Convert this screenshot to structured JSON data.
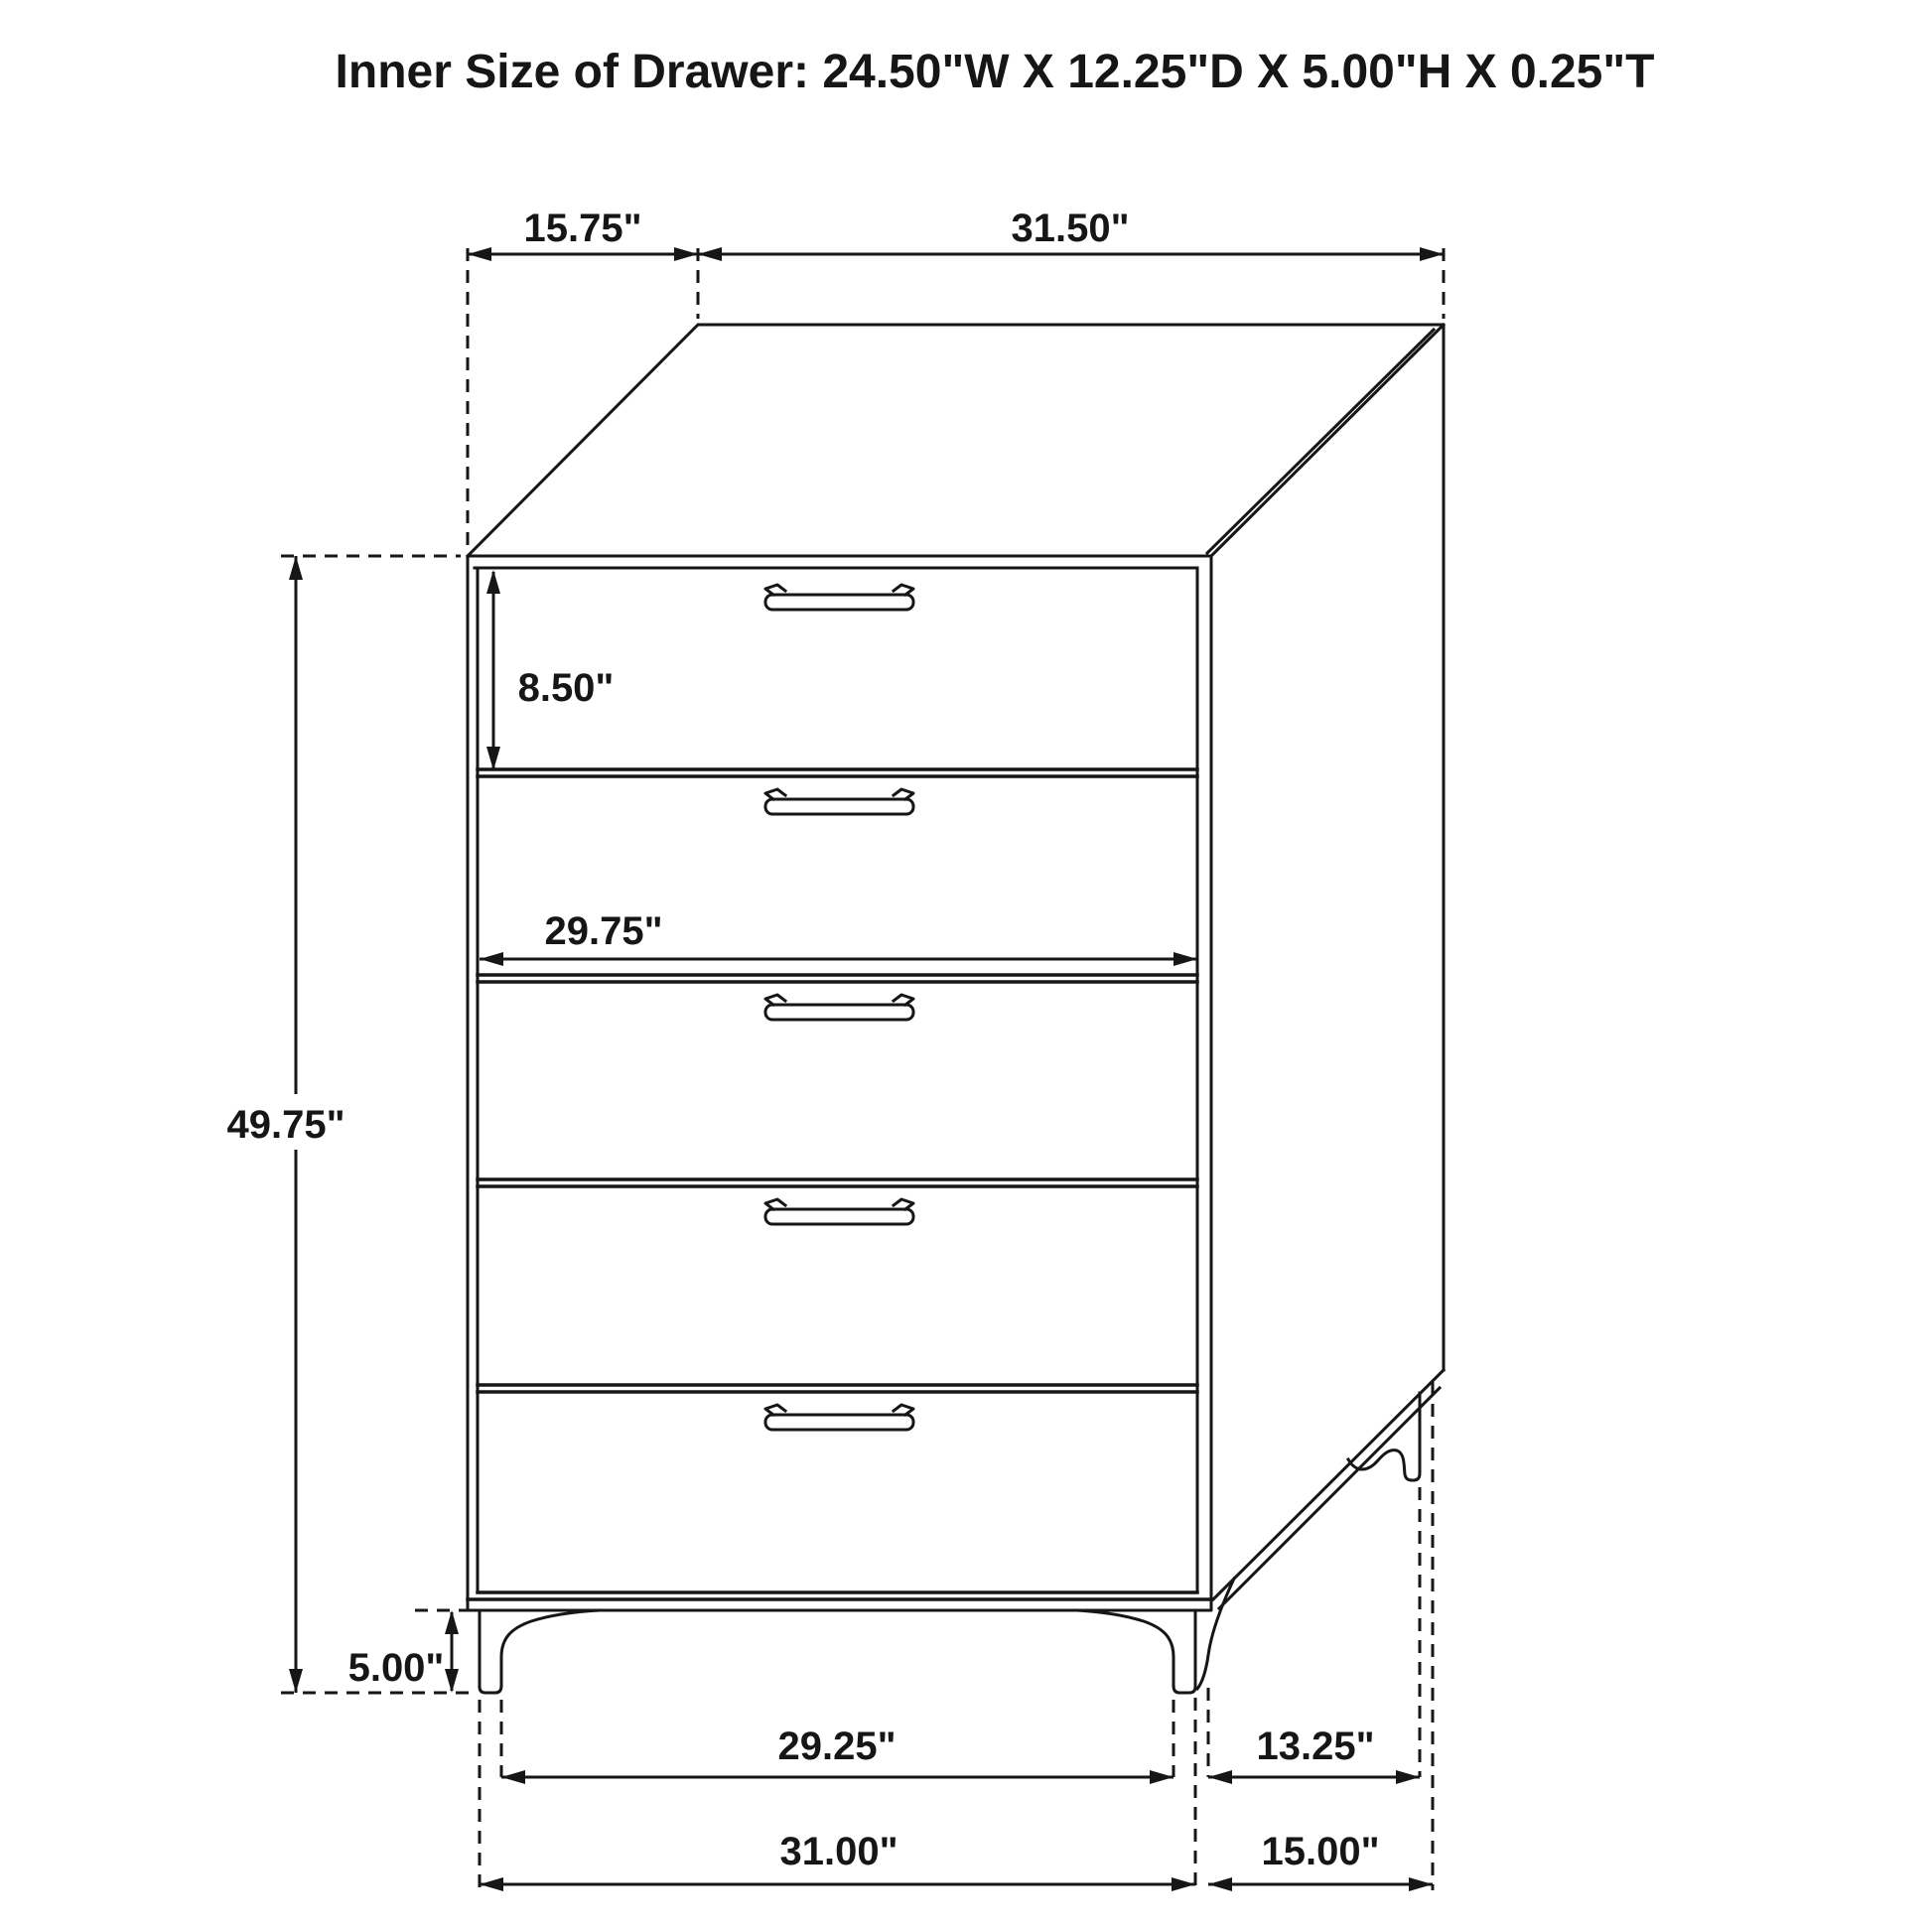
{
  "title": "Inner Size of Drawer: 24.50\"W X 12.25\"D X 5.00\"H X 0.25\"T",
  "dims": {
    "top_depth": "15.75\"",
    "top_width": "31.50\"",
    "first_drawer_height": "8.50\"",
    "drawer_front_width": "29.75\"",
    "overall_height": "49.75\"",
    "leg_height": "5.00\"",
    "front_leg_inner_span": "29.25\"",
    "side_leg_span": "13.25\"",
    "base_front_width": "31.00\"",
    "base_side_depth": "15.00\""
  },
  "figure": {
    "type": "furniture-dimension-diagram",
    "subject": "5-drawer chest",
    "drawer_count": 5,
    "line_color": "#161616",
    "background_color": "#ffffff"
  }
}
